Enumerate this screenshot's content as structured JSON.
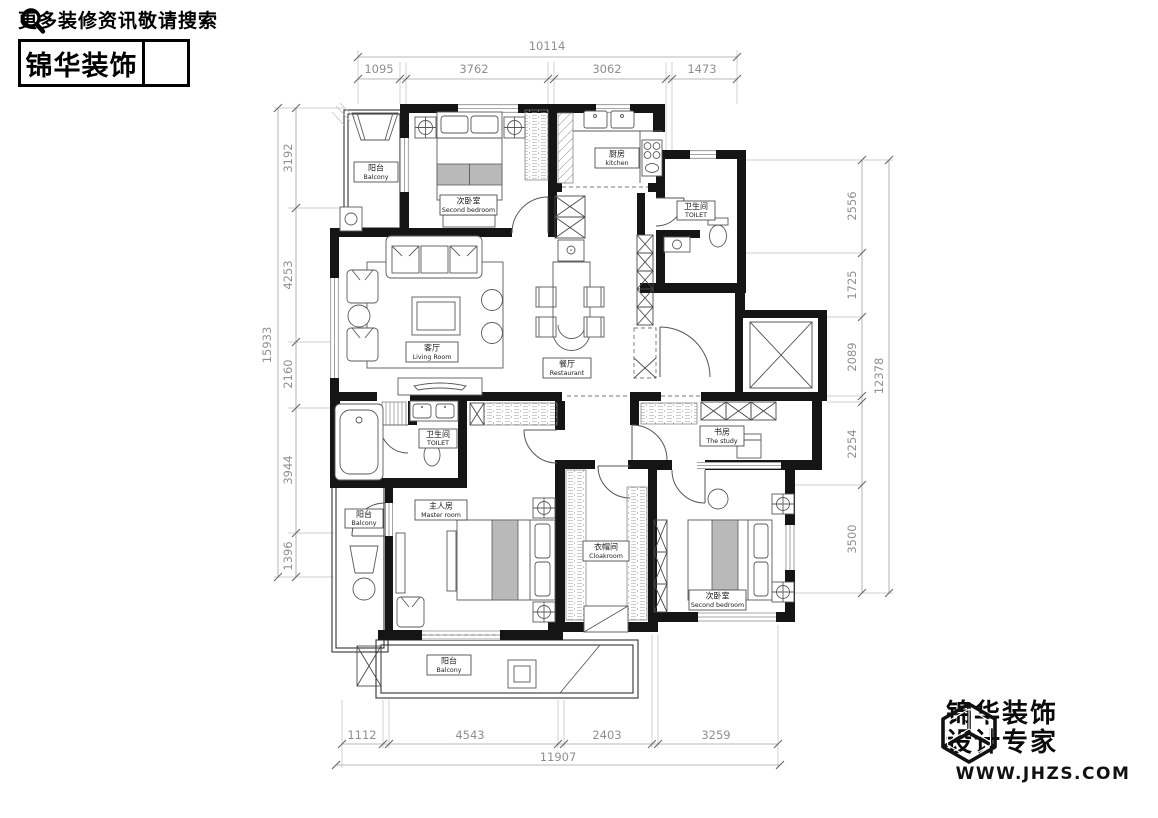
{
  "header": {
    "tagline": "更多装修资讯敬请搜索",
    "brand": "锦华装饰"
  },
  "footer": {
    "brand_line1": "锦华装饰",
    "brand_line2": "设计专家",
    "website": "WWW.JHZS.COM"
  },
  "plan": {
    "rooms": [
      {
        "id": "balcony-top",
        "cn": "阳台",
        "en": "Balcony"
      },
      {
        "id": "second-bedroom-top",
        "cn": "次卧室",
        "en": "Second bedroom"
      },
      {
        "id": "kitchen",
        "cn": "厨房",
        "en": "kitchen"
      },
      {
        "id": "toilet-top",
        "cn": "卫生间",
        "en": "TOILET"
      },
      {
        "id": "living-room",
        "cn": "客厅",
        "en": "Living Room"
      },
      {
        "id": "restaurant",
        "cn": "餐厅",
        "en": "Restaurant"
      },
      {
        "id": "toilet-master",
        "cn": "卫生间",
        "en": "TOILET"
      },
      {
        "id": "study",
        "cn": "书房",
        "en": "The study"
      },
      {
        "id": "balcony-left",
        "cn": "阳台",
        "en": "Balcony"
      },
      {
        "id": "master-room",
        "cn": "主人房",
        "en": "Master room"
      },
      {
        "id": "cloakroom",
        "cn": "衣帽间",
        "en": "Cloakroom"
      },
      {
        "id": "second-bedroom-bottom",
        "cn": "次卧室",
        "en": "Second bedroom"
      },
      {
        "id": "balcony-bottom",
        "cn": "阳台",
        "en": "Balcony"
      }
    ],
    "dims": {
      "top": {
        "total": "10114",
        "segments": [
          "1095",
          "3762",
          "3062",
          "1473"
        ]
      },
      "left": {
        "total": "15933",
        "segments": [
          "3192",
          "4253",
          "2160",
          "3944",
          "1396"
        ]
      },
      "right": {
        "total": "12378",
        "segments": [
          "2556",
          "1725",
          "2089",
          "2254",
          "3500"
        ]
      },
      "bottom": {
        "total": "11907",
        "segments": [
          "1112",
          "4543",
          "2403",
          "3259"
        ]
      }
    },
    "colors": {
      "wall": "#151515",
      "dimension": "#8f8f8f",
      "furniture": "#5a5a5a"
    }
  }
}
